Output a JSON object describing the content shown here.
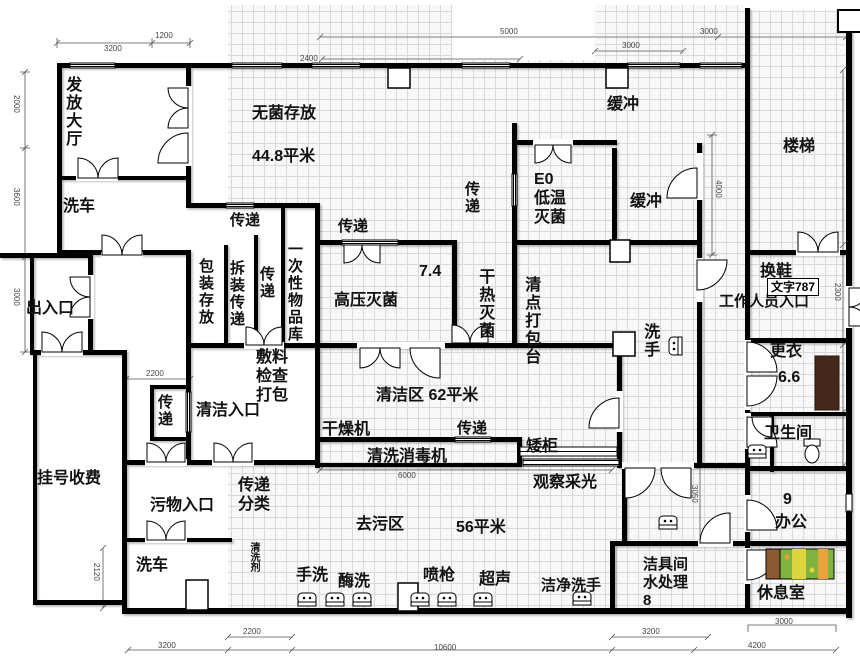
{
  "drawing_type": "floor-plan",
  "colors": {
    "wall": "#000000",
    "grid_line": "#d9d9d9",
    "grid_bg": "#f8f8f8",
    "dimension_text": "#444444",
    "bench_brown": "#46281a",
    "bed_pillow": "#8a5a33",
    "bed_green": "#7fb33e",
    "bed_yellow": "#ddd53e",
    "bed_orange": "#e8a33f"
  },
  "rooms": {
    "issue_hall": "发放大厅",
    "cart_wash_top": "洗车",
    "sterile_storage": "无菌存放",
    "sterile_storage_area": "44.8平米",
    "buffer_top": "缓冲",
    "stairs": "楼梯",
    "eo_sterilizer": "E0\n低温\n灭菌",
    "buffer_right": "缓冲",
    "value_7_4": "7.4",
    "high_pressure": "高压灭菌",
    "dry_heat": "干热灭菌",
    "checkin_pack_table": "清点打包台",
    "packing_storage": "包装存放",
    "dismantle_pass": "拆装传递",
    "disposable_store": "一次性物品库",
    "dressing_check_pack": "敷料\n检查\n打包",
    "clean_entry": "清洁入口",
    "entrance_exit": "出入口",
    "registration": "挂号收费",
    "dirty_entry": "污物入口",
    "pass_sort": "传递\n分类",
    "detergent": "清洗剂",
    "cart_wash_bottom": "洗车",
    "dryer": "干燥机",
    "clean_zone": "清洁区 62平米",
    "low_cabinet": "矮柜",
    "washer_disinfector": "清洗消毒机",
    "observe_light": "观察采光",
    "hand_wash_clean": "洗手",
    "shoe_change": "换鞋",
    "text787": "文字787",
    "staff_entrance": "工作人员入口",
    "changing": "更衣",
    "value_6_6": "6.6",
    "toilet": "卫生间",
    "value_9": "9",
    "office": "办公",
    "mop_water": "洁具间\n水处理\n8",
    "rest_room": "休息室",
    "clean_hand_wash": "洁净洗手",
    "hand_wash": "手洗",
    "enzyme_wash": "酶洗",
    "spray_gun": "喷枪",
    "ultrasonic": "超声",
    "decontam_zone": "去污区",
    "decontam_area": "56平米"
  },
  "pass": {
    "eo": "传递",
    "top_left": "传递",
    "top_mid": "传递",
    "cluster": "传递",
    "left_niche": "传递",
    "mid": "传递"
  },
  "dimensions": {
    "top_3200": "3200",
    "top_1200": "1200",
    "top_2400": "2400",
    "top_5000": "5000",
    "top_3000_a": "3000",
    "top_3000_b": "3000",
    "left_2000": "2000",
    "left_3600": "3600",
    "left_3000": "3000",
    "left_2120": "2120",
    "right_4000": "4000",
    "right_2300": "2300",
    "right_3050": "3050",
    "mid_2200": "2200",
    "mid_6000": "6000",
    "bottom_2200": "2200",
    "bottom_3200_a": "3200",
    "bottom_10600": "10600",
    "bottom_3200_b": "3200",
    "bottom_4200": "4200",
    "bottom_3000": "3000"
  }
}
